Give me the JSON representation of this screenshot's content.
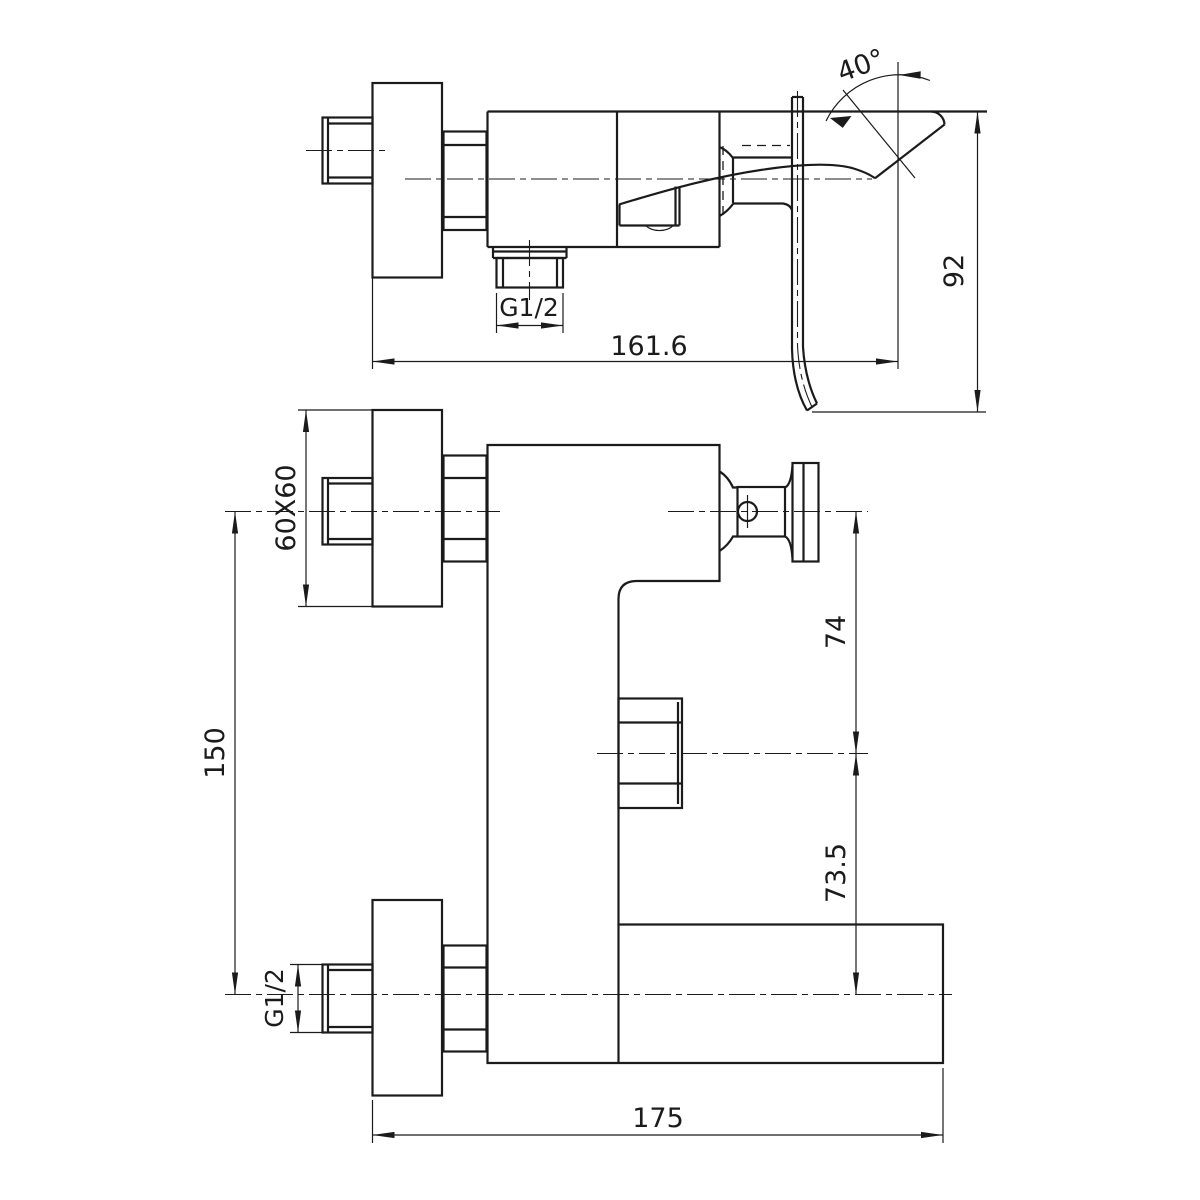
{
  "drawing": {
    "type": "faucet technical drawing, two orthographic views",
    "colors": {
      "line": "#1b1b1b",
      "background": "#ffffff"
    },
    "dimensions": {
      "side_view": {
        "handle_angle": "40°",
        "spout_drop_height": "92",
        "body_length": "161.6",
        "outlet_thread": "G1/2"
      },
      "front_view": {
        "plate_size": "60X60",
        "inlet_spacing": "150",
        "pivot_to_diverter": "74",
        "diverter_to_spout": "73.5",
        "inlet_thread": "G1/2",
        "total_width": "175"
      }
    }
  }
}
